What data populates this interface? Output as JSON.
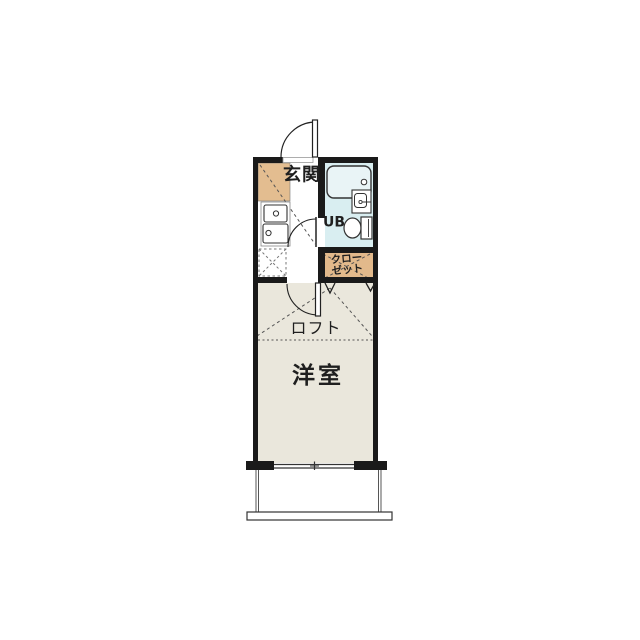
{
  "image_type": "apartment-floor-plan",
  "colors": {
    "wall": "#1a1a1a",
    "cabinet_tan": "#e3bd90",
    "closet_tan": "#e2b98b",
    "bath_cyan": "#d9eef1",
    "tub_fill": "#e9f4f6",
    "room_floor": "#eae7dc",
    "fixture_line": "#333333",
    "dash_line": "#555555"
  },
  "rooms": {
    "entrance_label": "玄関",
    "unit_bath_label": "UB",
    "closet_label_line1": "クロー",
    "closet_label_line2": "ゼット",
    "loft_label": "ロフト",
    "western_room_label": "洋室"
  }
}
